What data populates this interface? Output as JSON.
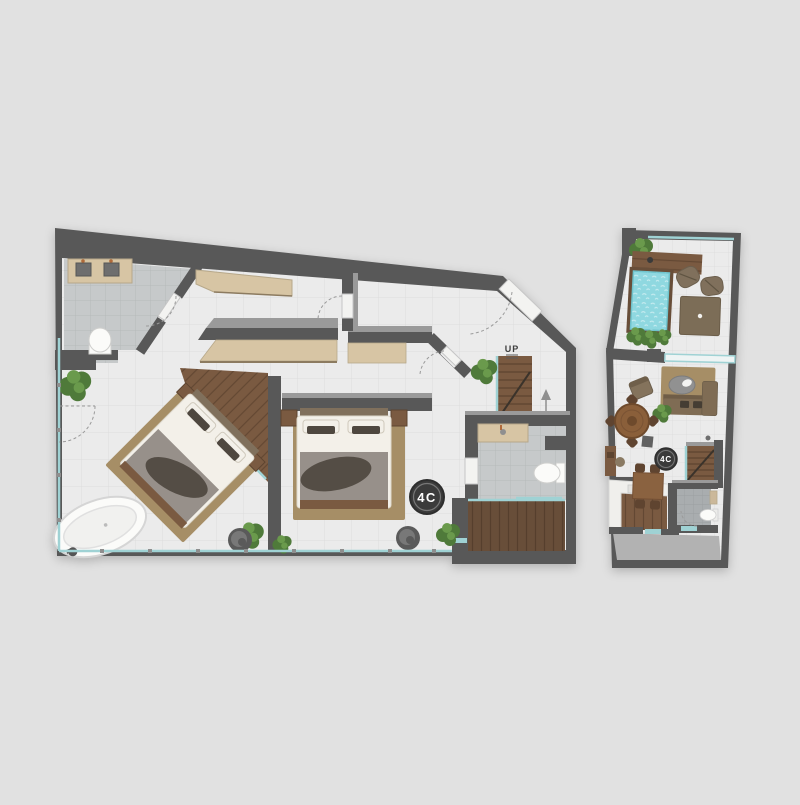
{
  "sheet": {
    "description_label": ""
  },
  "colors": {
    "background": "#e1e1e1",
    "wall": "#585858",
    "wall_light": "#9a9a9a",
    "floor": "#ebebeb",
    "floor_line": "#dcdcdc",
    "bath_floor": "#c6c9ca",
    "bath_floor_2": "#a9adaf",
    "wood": "#7a5a41",
    "wood_dark": "#684e39",
    "closet": "#d7c5a4",
    "rug": "#a68e66",
    "linen": "#f3f0e9",
    "blanket": "#97908a",
    "throw": "#544d45",
    "taupe": "#80705c",
    "pool": "#8fd8e0",
    "glass": "#9fd2d4",
    "plant": "#4f7a3a",
    "plant_light": "#6a9a4c",
    "pot": "#5a5a5a",
    "concrete": "#b2b2b2",
    "fixture": "#fbfbf9",
    "badge": "#3b3b3b",
    "badge_text": "#ffffff"
  },
  "lower_plan": {
    "unit_badge": "4C",
    "stairs_label": "UP"
  },
  "upper_plan": {
    "unit_badge": "4C"
  },
  "icons": {
    "bed-icon": "double bed with pillows, duvet and throw",
    "bathtub-icon": "freestanding oval tub",
    "toilet-icon": "wc bowl with tank",
    "vanity-icon": "counter with sink basins",
    "stairs-icon": "wood stair run with treads",
    "plant-icon": "potted greenery blob",
    "pot-icon": "round planter stool",
    "pool-icon": "plunge pool with wood deck",
    "sofa-icon": "sofa with chaise",
    "coffee-table-icon": "oval table",
    "round-table-icon": "round wood dining table with chairs",
    "dining-table-icon": "rectangular table with four chairs",
    "beanbag-icon": "lounge beanbag",
    "daybed-icon": "square day bed",
    "kitchen-counter-icon": "L-shaped white counter with sink",
    "arrow-up-icon": "direction arrow",
    "door-swing-icon": "dashed quarter-circle swing"
  }
}
